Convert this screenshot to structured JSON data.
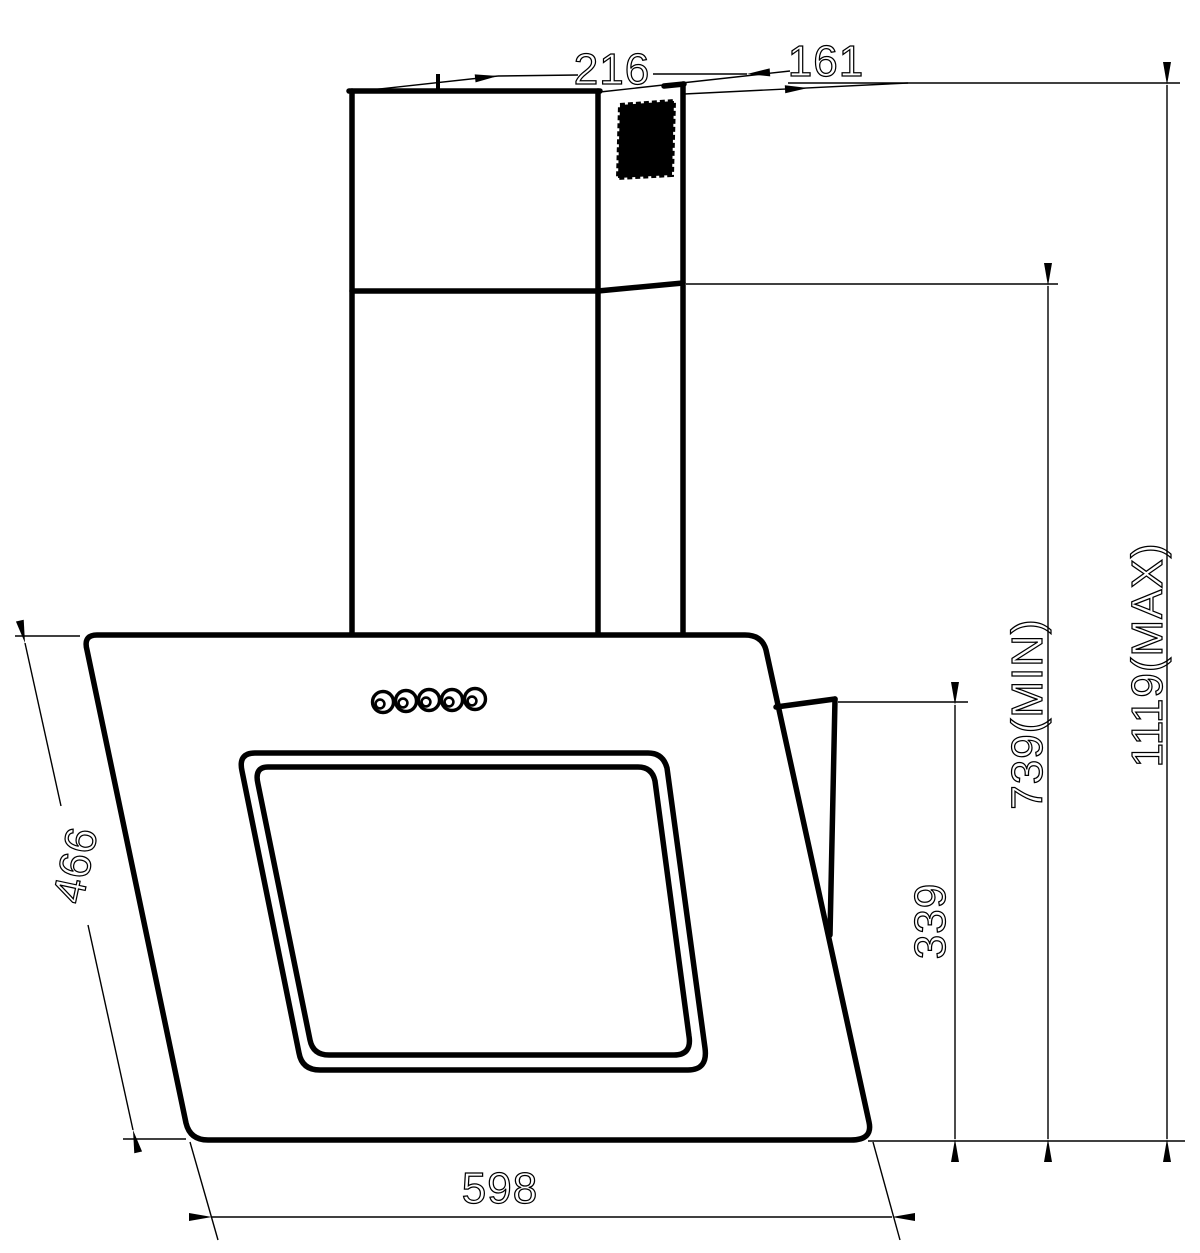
{
  "drawing": {
    "type": "technical-dimension-drawing",
    "subject": "angled wall-mounted cooker hood, side-perspective view",
    "colors": {
      "ink": "#000000",
      "paper": "#ffffff"
    },
    "dims": {
      "d216": {
        "label": "216",
        "meaning": "chimney top depth"
      },
      "d161": {
        "label": "161",
        "meaning": "chimney top offset"
      },
      "d1119": {
        "label": "1119(MAX)",
        "meaning": "maximum overall height"
      },
      "d739": {
        "label": "739(MIN)",
        "meaning": "minimum overall height"
      },
      "d339": {
        "label": "339",
        "meaning": "hood back panel height"
      },
      "d466": {
        "label": "466",
        "meaning": "slanted glass panel length"
      },
      "d598": {
        "label": "598",
        "meaning": "hood body width"
      }
    }
  }
}
